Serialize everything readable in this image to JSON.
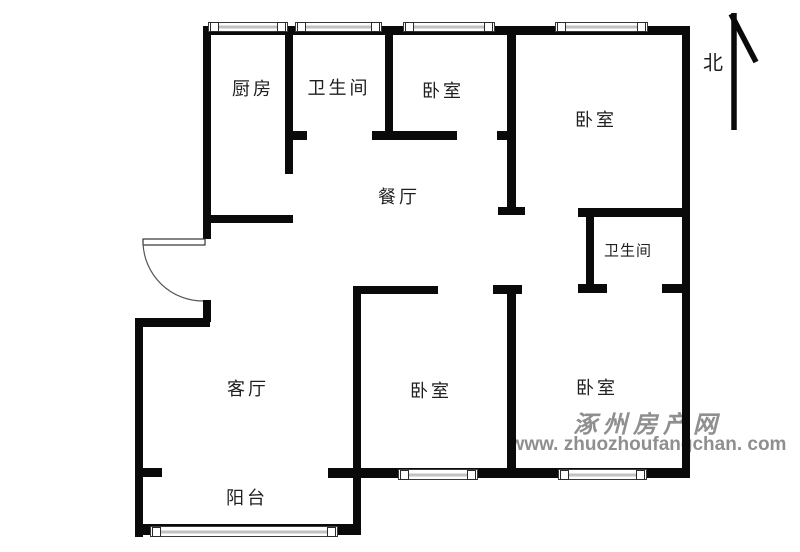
{
  "floor_plan": {
    "north_indicator": {
      "label": "北"
    },
    "rooms": [
      {
        "name": "kitchen",
        "label": "厨房"
      },
      {
        "name": "bathroom-top",
        "label": "卫生间"
      },
      {
        "name": "bedroom-top-middle",
        "label": "卧室"
      },
      {
        "name": "bedroom-top-right",
        "label": "卧室"
      },
      {
        "name": "dining-room",
        "label": "餐厅"
      },
      {
        "name": "bathroom-right",
        "label": "卫生间"
      },
      {
        "name": "living-room",
        "label": "客厅"
      },
      {
        "name": "bedroom-bottom-middle",
        "label": "卧室"
      },
      {
        "name": "bedroom-bottom-right",
        "label": "卧室"
      },
      {
        "name": "balcony",
        "label": "阳台"
      }
    ]
  },
  "watermark": {
    "site_name": "涿州房产网",
    "site_url": "www. zhuozhoufangchan. com"
  },
  "colors": {
    "wall": "#0a0a0a",
    "label_text": "#1f1f1f",
    "watermark_gray": "#8f8f8f"
  }
}
